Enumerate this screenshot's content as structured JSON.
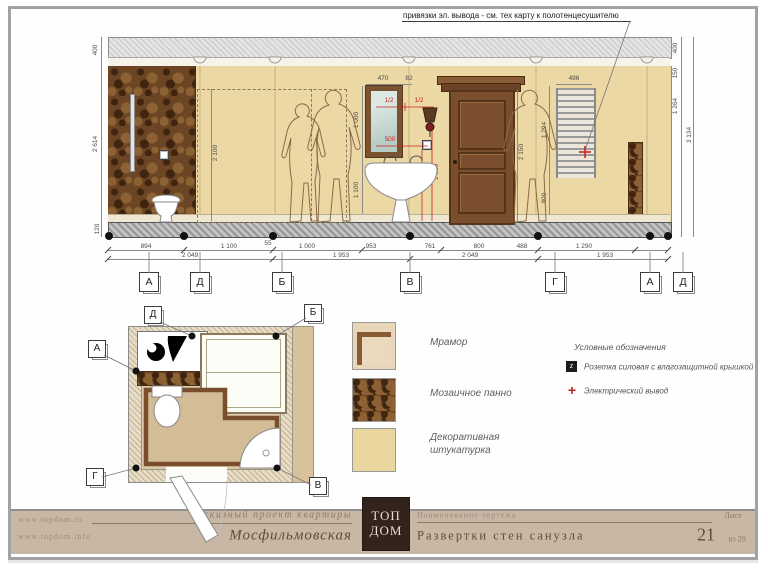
{
  "annotation": "привязки эл. вывода - см. тех карту к полотенцесушителю",
  "elevation": {
    "dims": {
      "left_top": "400",
      "left_height": "2 614",
      "left_base": "120",
      "right_top": "400",
      "right_cornice": "150",
      "right_upper": "1 264",
      "right_total": "3 134",
      "mirror_width": "470",
      "mirror_offset": "82",
      "mirror_height": "1 000",
      "below_mirror": "1 100",
      "dashed_height": "2 100",
      "door_height": "2 150",
      "towel_width": "496",
      "towel_height": "1 294",
      "towel_below": "800"
    },
    "red_dims": {
      "half_left": "1/2",
      "half_right": "1/2",
      "socket_offset": "500",
      "outlet_height": "1 200",
      "sconce_height": "1 550"
    },
    "chain_row1": [
      "894",
      "1 100",
      "55",
      "1 000",
      "953",
      "761",
      "800",
      "488",
      "1 290"
    ],
    "chain_row2": [
      "2 049",
      "1 953",
      "2 049",
      "1 953"
    ],
    "markers": [
      "А",
      "Д",
      "Б",
      "В",
      "Г",
      "А",
      "Д"
    ]
  },
  "plan": {
    "markers": {
      "top_left": "Д",
      "top_right": "Б",
      "left": "А",
      "bottom_left": "Г",
      "bottom_right": "В"
    }
  },
  "materials": [
    {
      "name": "Мрамор"
    },
    {
      "name": "Мозаичное панно"
    },
    {
      "name": "Декоративная штукатурка"
    }
  ],
  "symbols": {
    "title": "Условные обозначения",
    "socket_glyph": "z",
    "socket_label": "Розетка силовая с влагозащитной крышкой",
    "outlet_glyph": "+",
    "outlet_label": "Электрический вывод"
  },
  "title_block": {
    "url1": "www.topdom.ru",
    "url2": "www.topdom.info",
    "project_type": "Эскизный проект квартиры",
    "object_name": "Мосфильмовская",
    "logo_line1": "ТОП",
    "logo_line2": "ДОМ",
    "drawing_label": "Наименование чертежа",
    "drawing_title": "Развертки стен санузла",
    "sheet_label": "Лист",
    "sheet_number": "21",
    "sheet_total": "из 29"
  },
  "colors": {
    "accent_red": "#cc2222",
    "wall": "#ecd8a5",
    "mosaic": "#6b4524",
    "door": "#7b4f2d",
    "title_strip": "#c9b7a5",
    "logo_bg": "#32231d"
  }
}
